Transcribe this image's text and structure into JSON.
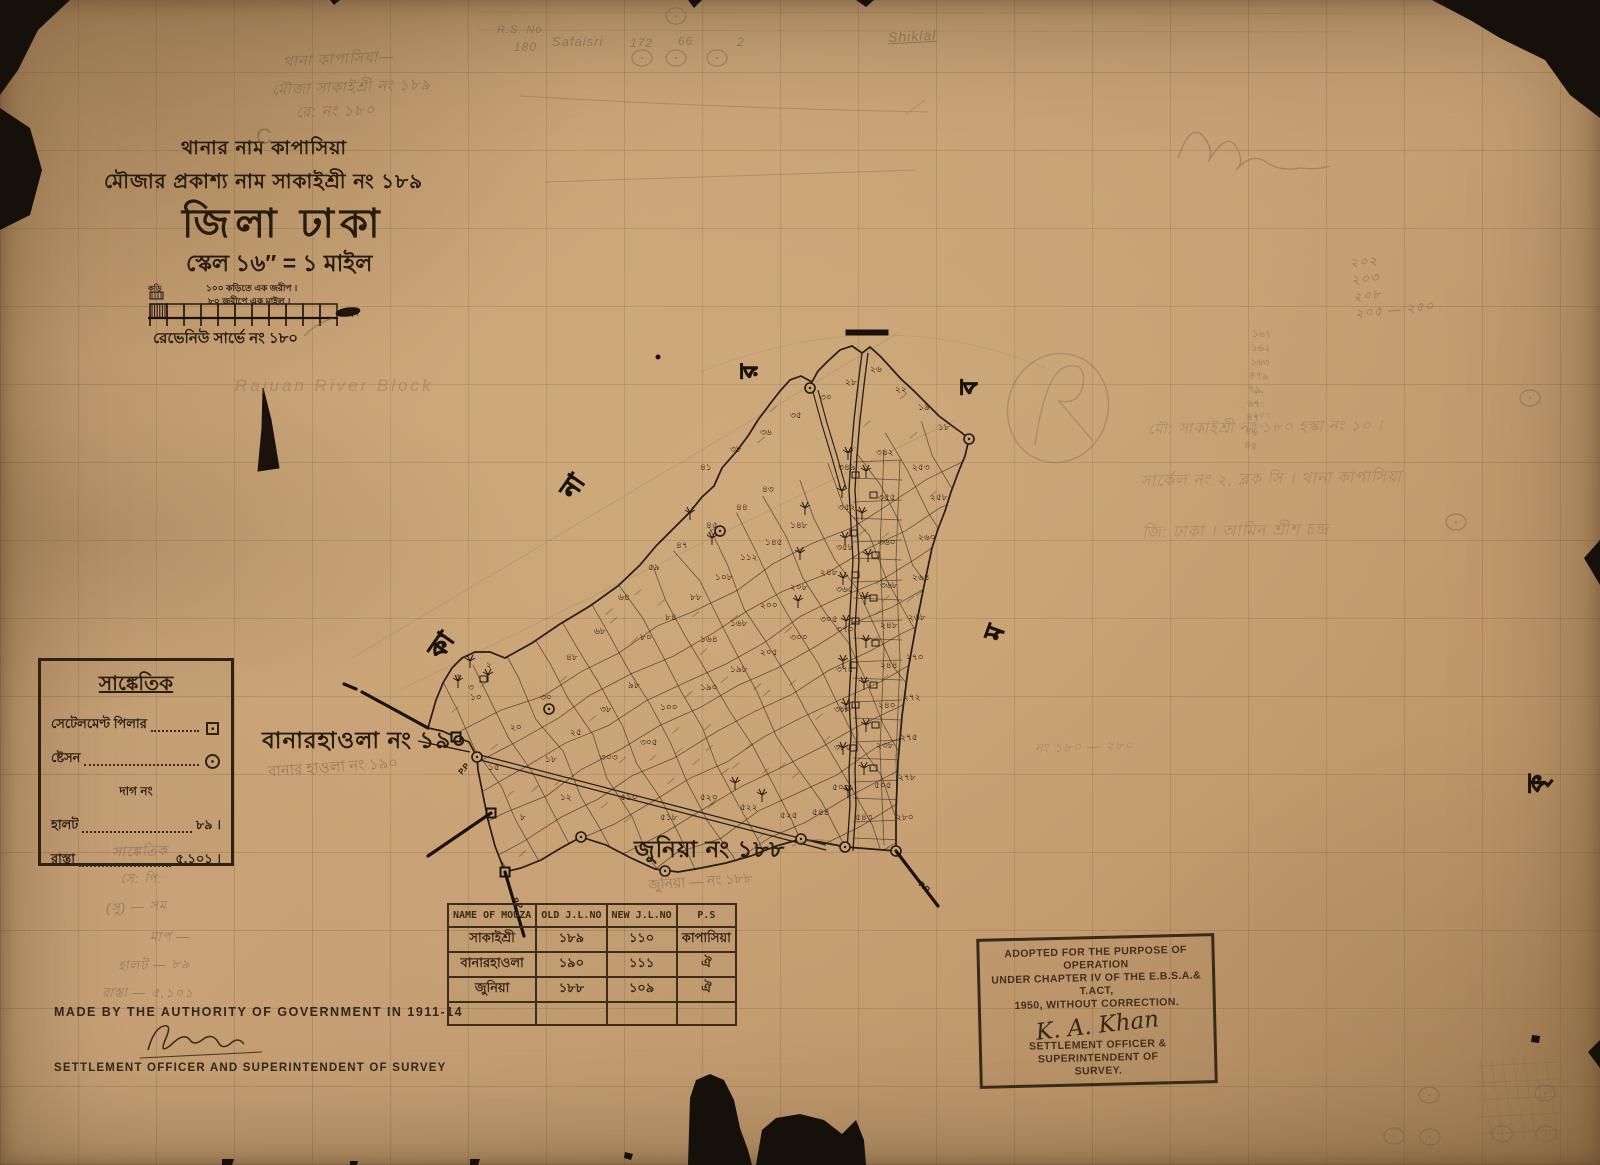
{
  "header": {
    "line1": "থানার নাম কাপাসিয়া",
    "line2": "মৌজার প্রকাশ্য নাম   সাকাইশ্রী নং ১৮৯",
    "district": "জিলা ঢাকা",
    "scale": "স্কেল ১৬″ = ১ মাইল"
  },
  "scale_bar": {
    "caption1": "১০০ কড়িতে এক জরীপ ।",
    "caption2": "৮০ জরীপে এক মাইল ।",
    "left_label": "কড়ি",
    "right_label": "মাইল",
    "note": "রেভেনিউ সার্ভে নং ১৮০"
  },
  "legend": {
    "title": "সাঙ্কেতিক",
    "items": [
      {
        "label": "সেটেলমেণ্ট পিলার",
        "type": "pillar"
      },
      {
        "label": "ষ্টেসন",
        "type": "station"
      },
      {
        "label": "দাগ নং",
        "type": "center"
      },
      {
        "label": "হালট",
        "type": "value",
        "value": "৮৯ ।"
      },
      {
        "label": "রাস্তা",
        "type": "value",
        "value": "৫,১০১ ।"
      }
    ]
  },
  "labels": {
    "banar": "বানারহাওলা নং ১৯০",
    "banar_pencil": "বানার হাওলা নং ১৯০",
    "junia": "জুনিয়া নং ১৮৮",
    "junia_pencil": "জুনিয়া — নং ১৮৮"
  },
  "table": {
    "headers": [
      "NAME OF MOUZA",
      "OLD J.L.NO",
      "NEW J.L.NO",
      "P.S"
    ],
    "rows": [
      [
        "সাকাইশ্রী",
        "১৮৯",
        "১১০",
        "কাপাসিয়া"
      ],
      [
        "বানারহাওলা",
        "১৯০",
        "১১১",
        "ঐ"
      ],
      [
        "জুনিয়া",
        "১৮৮",
        "১০৯",
        "ঐ"
      ],
      [
        "",
        "",
        "",
        ""
      ]
    ]
  },
  "stamp": {
    "lines": [
      "ADOPTED FOR THE PURPOSE OF OPERATION",
      "UNDER CHAPTER IV OF THE E.B.S.A.& T.ACT,",
      "1950, WITHOUT CORRECTION."
    ],
    "signature": "K. A. Khan",
    "lines2": [
      "SETTLEMENT OFFICER & SUPERINTENDENT OF",
      "SURVEY."
    ]
  },
  "footer": {
    "made_by": "MADE BY THE AUTHORITY OF GOVERNMENT IN 1911-14",
    "officer": "SETTLEMENT OFFICER AND SUPERINTENDENT OF SURVEY"
  },
  "pencil": {
    "c_mark": "C",
    "topleft": [
      "থানা কাপাসিয়া—",
      "মৌজা সাকাইশ্রী নং ১৮৯",
      "রে: নং ১৮০"
    ],
    "top_row": [
      "R.S. No.",
      "180",
      "Safaisri",
      "172",
      "66",
      "2",
      "Shiklal"
    ],
    "right_numbers": [
      "২০২",
      "২০৩",
      "২০৮",
      "২০৫ — ২৫০"
    ],
    "right_column": [
      "১৬৭",
      "১৬২",
      "১৬৩",
      "৪৭৯",
      "৭৯",
      "৬৭",
      "৪৭",
      "৪৬",
      "৪৫"
    ],
    "small_col": [
      "৭৭",
      "৭৩",
      "২০৩",
      "০২"
    ],
    "right_lines": [
      "মৌ: সাকাইশ্রী নং ১৮০  হস্কা নং ১০ ।",
      "সার্কেল নং ২,  ব্লক সি ।  থানা কাপাসিয়া",
      "জি: ঢাকা ।    আমিন শ্রীশ চন্দ্র"
    ],
    "mid_note": "নং ১৮০ — ২৮০",
    "river_note": "Rajuan River Block",
    "legend_pencil": [
      "সাঙ্কেতিক",
      "সে: পি:",
      "(সু) — সম",
      "মাপ —",
      "হালট — ৮৯",
      "রাস্তা — ৫,১০১"
    ]
  },
  "map": {
    "neighbor_letters": [
      {
        "t": "র",
        "x": 757,
        "y": 378,
        "r": -90
      },
      {
        "t": "ব",
        "x": 977,
        "y": 394,
        "r": -90
      },
      {
        "t": "না",
        "x": 573,
        "y": 500,
        "r": -55
      },
      {
        "t": "কা",
        "x": 441,
        "y": 660,
        "r": -55
      },
      {
        "t": "ম",
        "x": 1000,
        "y": 642,
        "r": -70
      },
      {
        "t": "কৃ",
        "x": 1545,
        "y": 792,
        "r": -90
      }
    ],
    "plot_numbers": [
      [
        618,
        600,
        "৬৪"
      ],
      [
        594,
        634,
        "৬৮"
      ],
      [
        566,
        660,
        "৪৮"
      ],
      [
        648,
        570,
        "৫৯"
      ],
      [
        676,
        548,
        "৪৭"
      ],
      [
        706,
        528,
        "৪৫"
      ],
      [
        736,
        510,
        "৪৪"
      ],
      [
        762,
        492,
        "৪৩"
      ],
      [
        700,
        470,
        "৪১"
      ],
      [
        730,
        452,
        "৩৮"
      ],
      [
        760,
        435,
        "৩৬"
      ],
      [
        790,
        418,
        "৩৫"
      ],
      [
        820,
        400,
        "৩০"
      ],
      [
        845,
        385,
        "২৮"
      ],
      [
        870,
        372,
        "২৬"
      ],
      [
        895,
        392,
        "২২"
      ],
      [
        918,
        410,
        "১৯"
      ],
      [
        938,
        430,
        "১৮"
      ],
      [
        640,
        640,
        "৮০"
      ],
      [
        665,
        620,
        "৮৪"
      ],
      [
        690,
        600,
        "৮৮"
      ],
      [
        715,
        580,
        "১০৮"
      ],
      [
        740,
        560,
        "১১২"
      ],
      [
        765,
        545,
        "১৪৫"
      ],
      [
        790,
        528,
        "১৪৮"
      ],
      [
        700,
        642,
        "১৬৪"
      ],
      [
        730,
        626,
        "১৬৮"
      ],
      [
        760,
        608,
        "২০০"
      ],
      [
        790,
        590,
        "২০৮"
      ],
      [
        820,
        575,
        "২৪৮"
      ],
      [
        700,
        690,
        "১৯০"
      ],
      [
        730,
        672,
        "১৯৮"
      ],
      [
        760,
        655,
        "২০৫"
      ],
      [
        790,
        640,
        "৩০০"
      ],
      [
        820,
        622,
        "৩০৫"
      ],
      [
        660,
        710,
        "১০০"
      ],
      [
        628,
        688,
        "৯৮"
      ],
      [
        600,
        712,
        "৩৮"
      ],
      [
        570,
        735,
        "২৫"
      ],
      [
        545,
        762,
        "১৮"
      ],
      [
        600,
        760,
        "৩০৩"
      ],
      [
        640,
        745,
        "৩০৫"
      ],
      [
        838,
        470,
        "৩৪৯"
      ],
      [
        876,
        455,
        "৩৪২"
      ],
      [
        838,
        510,
        "৩৫২"
      ],
      [
        878,
        500,
        "৩৫৫"
      ],
      [
        836,
        550,
        "৩৫৮"
      ],
      [
        878,
        545,
        "৩৬০"
      ],
      [
        836,
        592,
        "৩৬৫"
      ],
      [
        880,
        588,
        "৩৬৮"
      ],
      [
        836,
        632,
        "৩৭০"
      ],
      [
        880,
        628,
        "২৪৮"
      ],
      [
        836,
        672,
        "৩৭৫"
      ],
      [
        880,
        668,
        "২৪৪"
      ],
      [
        834,
        712,
        "৩৮০"
      ],
      [
        878,
        708,
        "২৪০"
      ],
      [
        834,
        750,
        "৩৮৫"
      ],
      [
        876,
        748,
        "২৩৮"
      ],
      [
        832,
        790,
        "৫০০"
      ],
      [
        874,
        788,
        "৫০৫"
      ],
      [
        855,
        820,
        "৫৪৩"
      ],
      [
        812,
        815,
        "৫৪৪"
      ],
      [
        912,
        470,
        "২৫৩"
      ],
      [
        930,
        500,
        "২৫৮"
      ],
      [
        918,
        540,
        "২৬০"
      ],
      [
        912,
        580,
        "২৬৪"
      ],
      [
        908,
        620,
        "২৬৮"
      ],
      [
        906,
        660,
        "২৭০"
      ],
      [
        903,
        700,
        "২৭২"
      ],
      [
        900,
        740,
        "২৭৫"
      ],
      [
        898,
        780,
        "২৭৮"
      ],
      [
        896,
        820,
        "২৮০"
      ],
      [
        700,
        800,
        "৫২০"
      ],
      [
        740,
        810,
        "৫২২"
      ],
      [
        780,
        818,
        "৫২৫"
      ],
      [
        660,
        820,
        "৫১৮"
      ],
      [
        620,
        800,
        "৫১০"
      ],
      [
        560,
        800,
        "১২"
      ],
      [
        520,
        820,
        "৮"
      ],
      [
        540,
        700,
        "৩০"
      ],
      [
        510,
        730,
        "২০"
      ],
      [
        488,
        770,
        "১৫"
      ],
      [
        470,
        700,
        "১০"
      ],
      [
        455,
        680,
        "৫"
      ],
      [
        468,
        690,
        "৩"
      ],
      [
        486,
        668,
        "২"
      ]
    ]
  }
}
